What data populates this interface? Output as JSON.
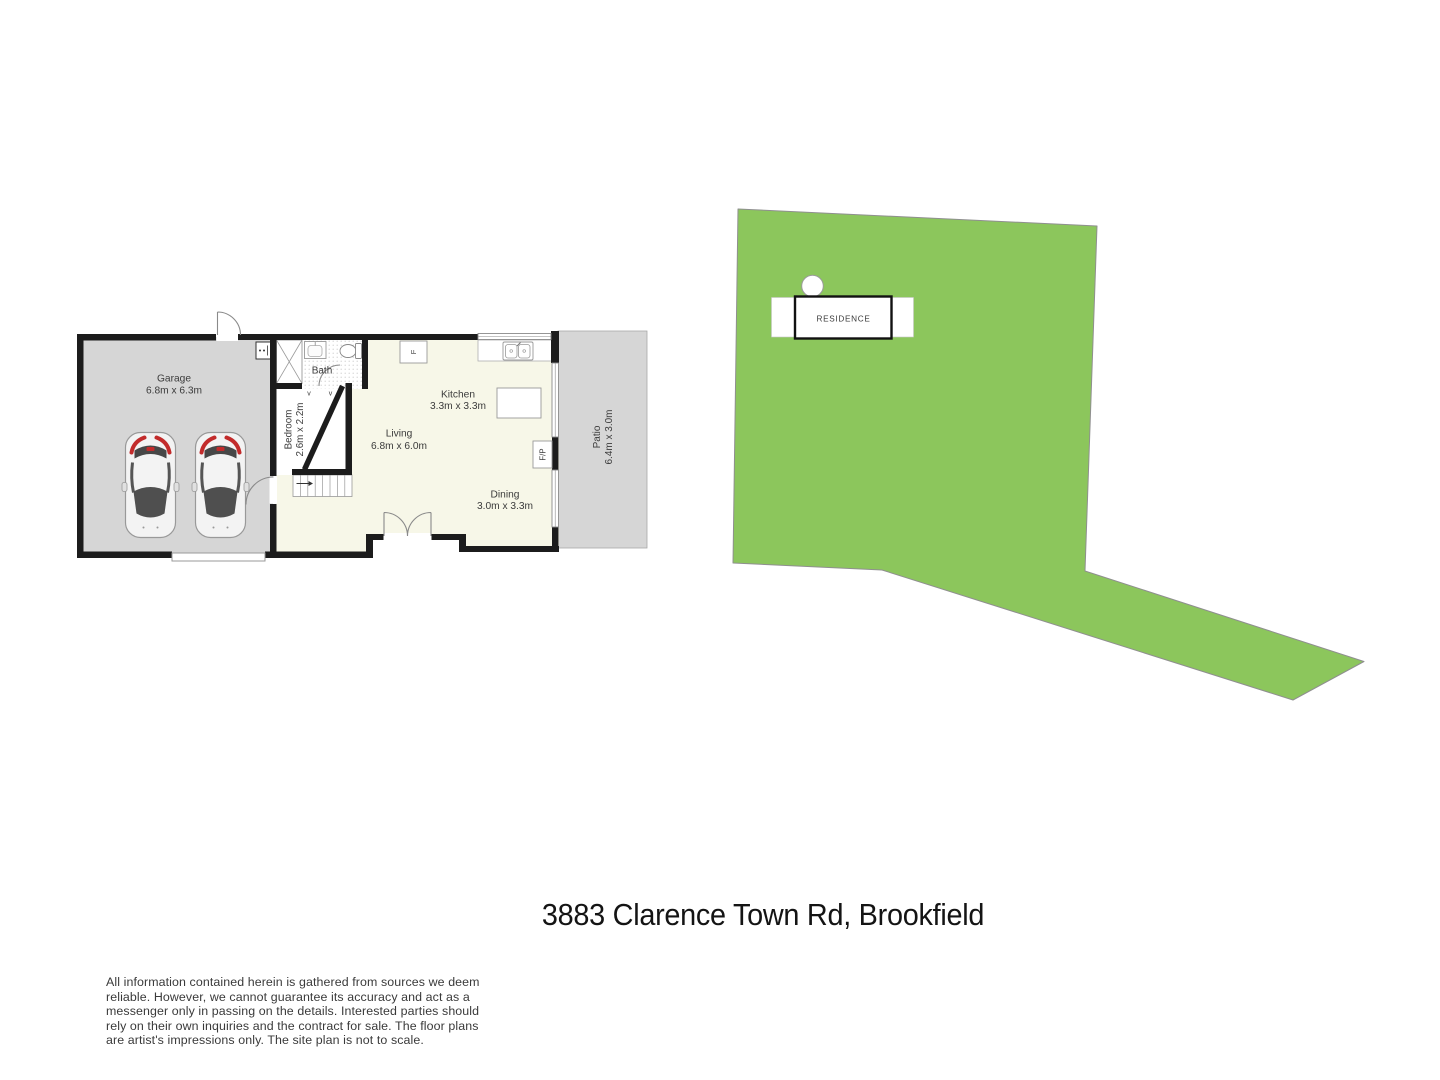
{
  "title": "3883 Clarence Town Rd, Brookfield",
  "floor_plan": {
    "rooms": {
      "garage": {
        "name": "Garage",
        "dims": "6.8m x 6.3m"
      },
      "bath": {
        "name": "Bath"
      },
      "bedroom": {
        "name": "Bedroom",
        "dims": "2.6m x 2.2m"
      },
      "living": {
        "name": "Living",
        "dims": "6.8m x 6.0m"
      },
      "kitchen": {
        "name": "Kitchen",
        "dims": "3.3m x 3.3m"
      },
      "dining": {
        "name": "Dining",
        "dims": "3.0m x 3.3m"
      },
      "patio": {
        "name": "Patio",
        "dims": "6.4m x 3.0m"
      }
    },
    "labels": {
      "fireplace": "F/P",
      "fridge": "F",
      "vent": "v"
    }
  },
  "site_plan": {
    "residence_label": "RESIDENCE"
  },
  "disclaimer_lines": [
    "All information contained herein is gathered from sources we deem",
    "reliable. However, we cannot guarantee its accuracy and act as a",
    "messenger only in passing on the details. Interested parties should",
    "rely on their own inquiries and the contract for sale. The floor plans",
    "are artist's impressions only. The site plan is not to scale."
  ],
  "colors": {
    "lot_green": "#8cc65c",
    "floor_gray": "#d6d6d6",
    "interior_cream": "#f7f7e8",
    "wall_black": "#1c1c1c"
  }
}
